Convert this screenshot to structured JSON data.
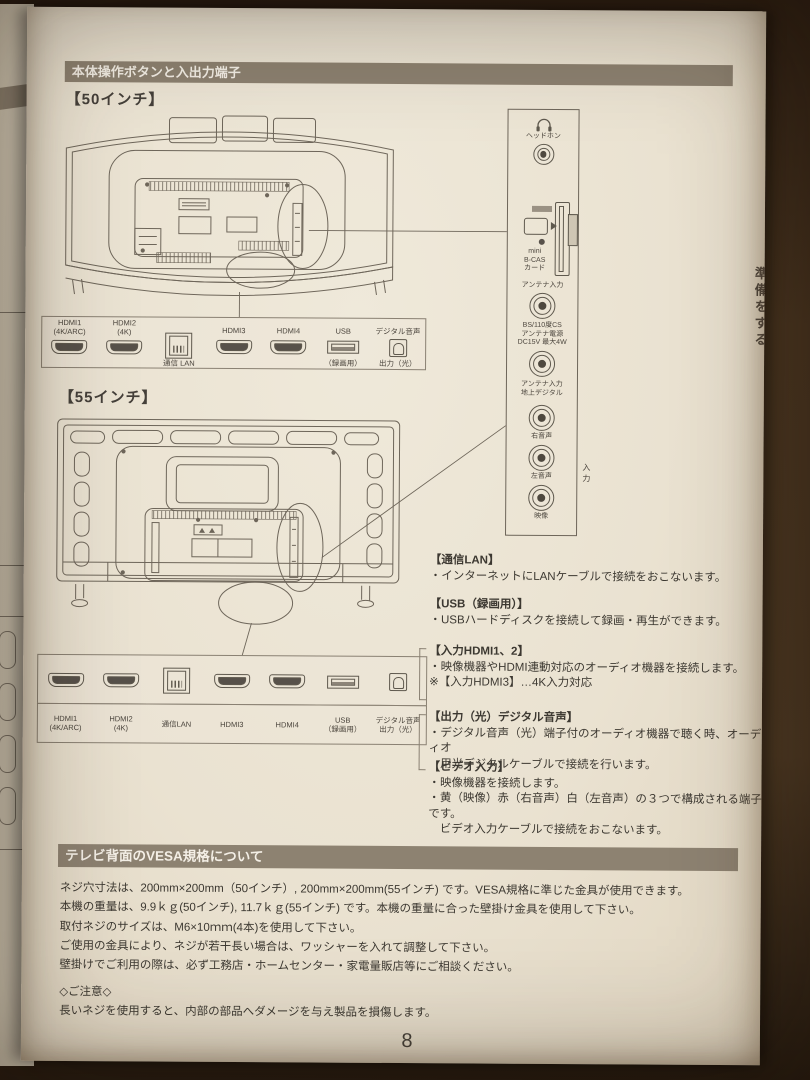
{
  "colors": {
    "background": "#3c2c1b",
    "paper": "#e9e1d0",
    "header_bar": "#8d8271",
    "ink": "#3f3a33",
    "line_art": "#6e665a"
  },
  "section1": {
    "title": "本体操作ボタンと入出力端子",
    "size50_label": "【50インチ】",
    "size55_label": "【55インチ】"
  },
  "ports50": [
    {
      "top": "HDMI1\n(4K/ARC)",
      "bottom": ""
    },
    {
      "top": "HDMI2\n(4K)",
      "bottom": ""
    },
    {
      "top": "",
      "bottom": "通信 LAN"
    },
    {
      "top": "HDMI3",
      "bottom": ""
    },
    {
      "top": "HDMI4",
      "bottom": ""
    },
    {
      "top": "USB",
      "bottom": "（録画用）"
    },
    {
      "top": "デジタル音声",
      "bottom": "出力（光）"
    }
  ],
  "ports55": [
    {
      "label": "HDMI1\n(4K/ARC)"
    },
    {
      "label": "HDMI2\n(4K)"
    },
    {
      "label": "通信LAN"
    },
    {
      "label": "HDMI3"
    },
    {
      "label": "HDMI4"
    },
    {
      "label": "USB\n（録画用）"
    },
    {
      "label": "デジタル音声\n出力（光）"
    }
  ],
  "side_panel": {
    "headphone_label": "ヘッドホン",
    "bcas_label": "mini\nB-CAS\nカード",
    "antenna_label": "アンテナ入力",
    "bs_label": "BS/110度CS\nアンテナ電源\nDC15V 最大4W",
    "terrestrial_label": "アンテナ入力\n地上デジタル",
    "audio_r_label": "右音声",
    "input_label": "入力",
    "audio_l_label": "左音声",
    "video_label": "映像"
  },
  "info_sections": [
    {
      "title": "【通信LAN】",
      "lines": [
        "・インターネットにLANケーブルで接続をおこないます。"
      ]
    },
    {
      "title": "【USB（録画用）】",
      "lines": [
        "・USBハードディスクを接続して録画・再生ができます。"
      ]
    },
    {
      "title": "【入力HDMI1、2】",
      "lines": [
        "・映像機器やHDMI連動対応のオーディオ機器を接続します。",
        "※【入力HDMI3】…4K入力対応"
      ]
    },
    {
      "title": "【出力（光）デジタル音声】",
      "lines": [
        "・デジタル音声（光）端子付のオーディオ機器で聴く時、オーディオ",
        "　用光デジタルケーブルで接続を行います。"
      ]
    },
    {
      "title": "【ビデオ入力】",
      "lines": [
        "・映像機器を接続します。",
        "・黄（映像）赤（右音声）白（左音声）の３つで構成される端子です。",
        "　ビデオ入力ケーブルで接続をおこないます。"
      ]
    }
  ],
  "vesa": {
    "title": "テレビ背面のVESA規格について",
    "lines": [
      "ネジ穴寸法は、200mm×200mm（50インチ）, 200mm×200mm(55インチ) です。VESA規格に準じた金具が使用できます。",
      "本機の重量は、9.9ｋｇ(50インチ), 11.7ｋｇ(55インチ) です。本機の重量に合った壁掛け金具を使用して下さい。",
      "取付ネジのサイズは、M6×10ｍｍ(4本)を使用して下さい。",
      "ご使用の金具により、ネジが若干長い場合は、ワッシャーを入れて調整して下さい。",
      "壁掛けでご利用の際は、必ず工務店・ホームセンター・家電量販店等にご相談ください。"
    ],
    "note_title": "◇ご注意◇",
    "note_line": "長いネジを使用すると、内部の部品へダメージを与え製品を損傷します。"
  },
  "page": {
    "number": "8",
    "side_tab": "準備をする"
  }
}
